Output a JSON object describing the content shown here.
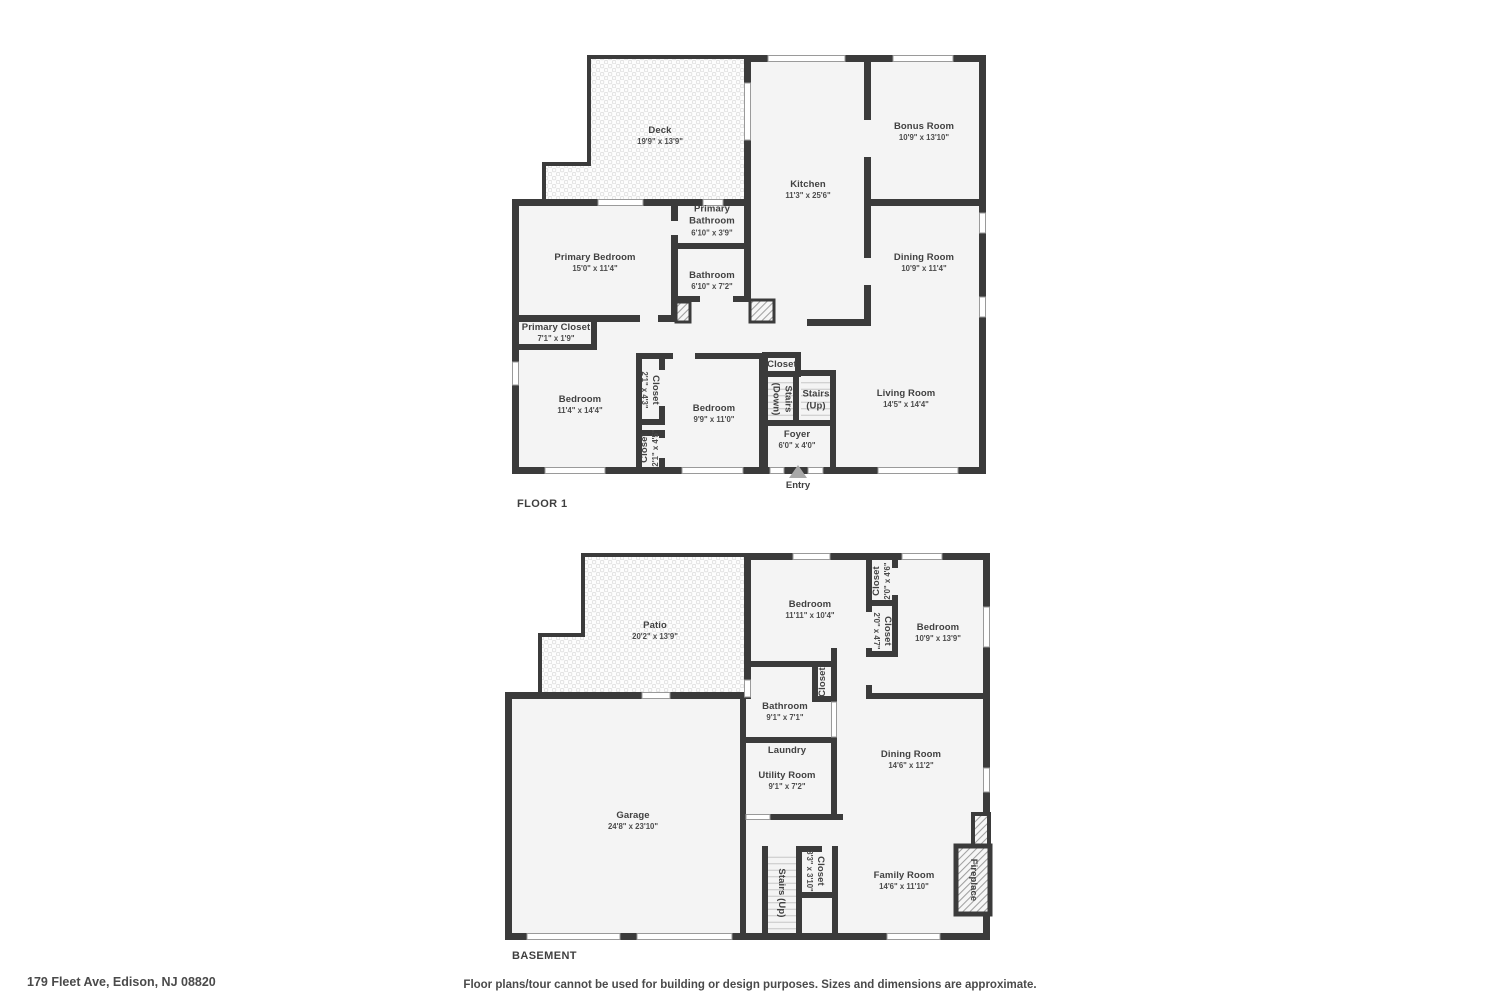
{
  "meta": {
    "address": "179 Fleet Ave, Edison, NJ 08820",
    "disclaimer": "Floor plans/tour cannot be used for building or design purposes. Sizes and dimensions are approximate."
  },
  "floor1": {
    "title": "FLOOR 1",
    "entry": "Entry",
    "rooms": {
      "deck": {
        "name": "Deck",
        "dims": "19'9\" x 13'9\""
      },
      "kitchen": {
        "name": "Kitchen",
        "dims": "11'3\" x 25'6\""
      },
      "bonus_room": {
        "name": "Bonus Room",
        "dims": "10'9\" x 13'10\""
      },
      "dining_room": {
        "name": "Dining Room",
        "dims": "10'9\" x 11'4\""
      },
      "primary_bedroom": {
        "name": "Primary Bedroom",
        "dims": "15'0\" x 11'4\""
      },
      "primary_bathroom": {
        "name": "Primary Bathroom",
        "dims": "6'10\" x 3'9\""
      },
      "bathroom": {
        "name": "Bathroom",
        "dims": "6'10\" x 7'2\""
      },
      "primary_closet": {
        "name": "Primary Closet",
        "dims": "7'1\" x 1'9\""
      },
      "bedroom_left": {
        "name": "Bedroom",
        "dims": "11'4\" x 14'4\""
      },
      "closet_a": {
        "name": "Closet",
        "dims": "2'1\" x 4'3\""
      },
      "closet_b": {
        "name": "Closet",
        "dims": "2'1\" x 4'5\""
      },
      "bedroom_middle": {
        "name": "Bedroom",
        "dims": "9'9\" x 11'0\""
      },
      "hall_closet": {
        "name": "Closet"
      },
      "stairs_down": {
        "name": "Stairs (Down)"
      },
      "stairs_up": {
        "name": "Stairs (Up)"
      },
      "foyer": {
        "name": "Foyer",
        "dims": "6'0\" x 4'0\""
      },
      "living_room": {
        "name": "Living Room",
        "dims": "14'5\" x 14'4\""
      }
    }
  },
  "basement": {
    "title": "BASEMENT",
    "rooms": {
      "patio": {
        "name": "Patio",
        "dims": "20'2\" x 13'9\""
      },
      "bedroom_left": {
        "name": "Bedroom",
        "dims": "11'11\" x 10'4\""
      },
      "closet_top": {
        "name": "Closet",
        "dims": "2'0\" x 4'6\""
      },
      "closet_mid": {
        "name": "Closet",
        "dims": "2'0\" x 4'7\""
      },
      "bedroom_right": {
        "name": "Bedroom",
        "dims": "10'9\" x 13'9\""
      },
      "hall_closet": {
        "name": "Closet"
      },
      "bathroom": {
        "name": "Bathroom",
        "dims": "9'1\" x 7'1\""
      },
      "laundry": {
        "name": "Laundry"
      },
      "utility_room": {
        "name": "Utility Room",
        "dims": "9'1\" x 7'2\""
      },
      "dining_room": {
        "name": "Dining Room",
        "dims": "14'6\" x 11'2\""
      },
      "garage": {
        "name": "Garage",
        "dims": "24'8\" x 23'10\""
      },
      "stairs_up": {
        "name": "Stairs (Up)"
      },
      "stairs_closet": {
        "name": "Closet",
        "dims": "3'3\" x 3'10\""
      },
      "family_room": {
        "name": "Family Room",
        "dims": "14'6\" x 11'10\""
      },
      "fireplace": {
        "name": "Fireplace"
      }
    }
  }
}
